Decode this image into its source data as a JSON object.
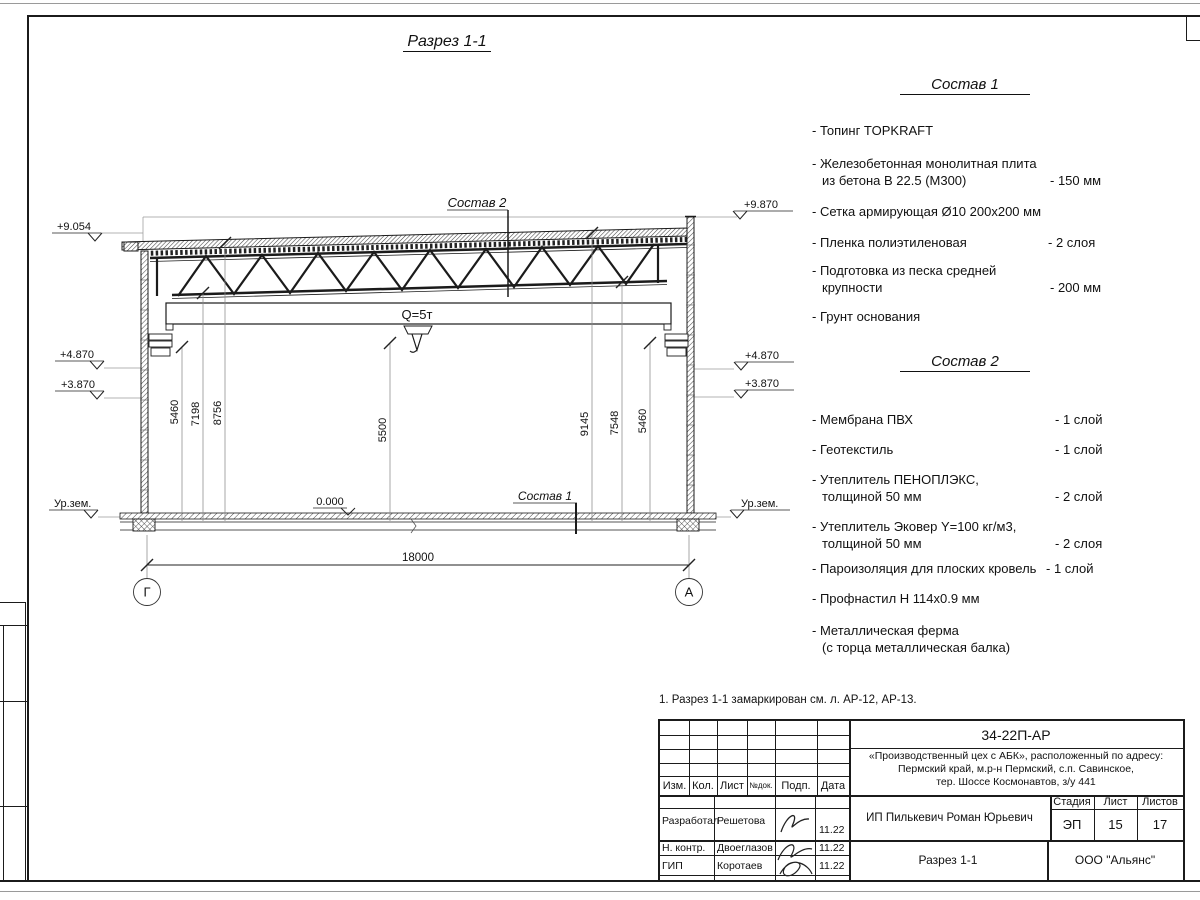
{
  "page": {
    "title": "Разрез 1-1",
    "note": "1. Разрез 1-1 замаркирован см. л. АР-12, АР-13."
  },
  "drawing": {
    "crane_label": "Q=5т",
    "zero_level": "0.000",
    "span_dim": "18000",
    "axis_left": "Г",
    "axis_right": "А",
    "sostav1_label": "Состав 1",
    "sostav2_label": "Состав 2",
    "elev_left": {
      "e1": "+9.054",
      "e2": "+4.870",
      "e3": "+3.870",
      "e4": "Ур.зем."
    },
    "elev_right": {
      "e1": "+9.870",
      "e2": "+4.870",
      "e3": "+3.870",
      "e4": "Ур.зем."
    },
    "dims": {
      "d1": "5460",
      "d2": "7198",
      "d3": "8756",
      "d4": "5500",
      "d5": "9145",
      "d6": "7548",
      "d7": "5460"
    }
  },
  "sostav1": {
    "heading": "Состав 1",
    "items": [
      {
        "l1": "- Топинг TOPKRAFT",
        "l2": "",
        "qty": ""
      },
      {
        "l1": "- Железобетонная  монолитная плита",
        "l2": "из бетона В 22.5 (М300)",
        "qty": "- 150 мм"
      },
      {
        "l1": "- Сетка армирующая Ø10 200х200 мм",
        "l2": "",
        "qty": ""
      },
      {
        "l1": "- Пленка полиэтиленовая",
        "l2": "",
        "qty": "-  2 слоя"
      },
      {
        "l1": "- Подготовка из песка средней",
        "l2": "крупности",
        "qty": "- 200 мм"
      },
      {
        "l1": "- Грунт основания",
        "l2": "",
        "qty": ""
      }
    ]
  },
  "sostav2": {
    "heading": "Состав 2",
    "items": [
      {
        "l1": "- Мембрана ПВХ",
        "l2": "",
        "qty": "- 1 слой"
      },
      {
        "l1": "- Геотекстиль",
        "l2": "",
        "qty": "- 1 слой"
      },
      {
        "l1": "- Утеплитель ПЕНОПЛЭКС,",
        "l2": "толщиной 50 мм",
        "qty": "- 2 слой"
      },
      {
        "l1": "- Утеплитель Эковер Y=100 кг/м3,",
        "l2": "толщиной 50 мм",
        "qty": "- 2 слоя"
      },
      {
        "l1": "- Пароизоляция для плоских кровель",
        "l2": "",
        "qty": "- 1 слой"
      },
      {
        "l1": "- Профнастил Н 114х0.9 мм",
        "l2": "",
        "qty": ""
      },
      {
        "l1": "- Металлическая ферма",
        "l2": "(с торца металлическая балка)",
        "qty": ""
      }
    ]
  },
  "titleblock": {
    "doc_number": "34-22П-АР",
    "address1": "«Производственный цех с АБК», расположенный по адресу:",
    "address2": "Пермский край, м.р-н Пермский, с.п. Савинское,",
    "address3": "тер. Шоссе Космонавтов, з/у 441",
    "headers": {
      "izm": "Изм.",
      "kol": "Кол.",
      "list": "Лист",
      "ndok": "№док.",
      "podp": "Подп.",
      "data": "Дата"
    },
    "rows": [
      {
        "role": "Разработал",
        "name": "Решетова",
        "date": "11.22"
      },
      {
        "role": "Н. контр.",
        "name": "Двоеглазов",
        "date": "11.22"
      },
      {
        "role": "ГИП",
        "name": "Коротаев",
        "date": "11.22"
      }
    ],
    "client": "ИП Пилькевич Роман Юрьевич",
    "stage_header": {
      "stage": "Стадия",
      "sheet": "Лист",
      "sheets": "Листов"
    },
    "stage_values": {
      "stage": "ЭП",
      "sheet": "15",
      "sheets": "17"
    },
    "sheet_name": "Разрез 1-1",
    "company": "ООО \"Альянс\""
  }
}
